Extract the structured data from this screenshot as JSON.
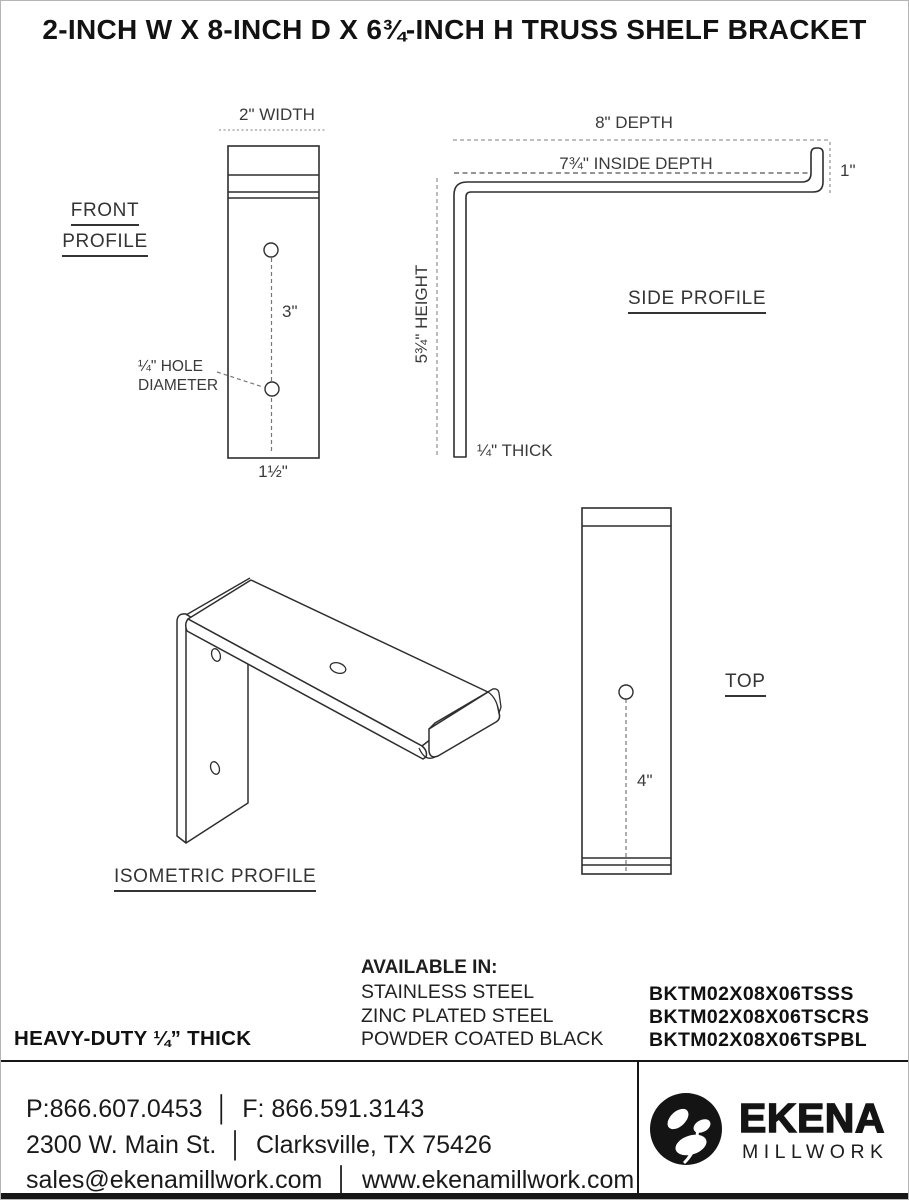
{
  "title": "2-INCH W X 8-INCH D X 6¾-INCH H TRUSS SHELF BRACKET",
  "views": {
    "front": {
      "label_line1": "FRONT",
      "label_line2": "PROFILE",
      "width_dim": "2\" WIDTH",
      "hole_spacing_dim": "3\"",
      "hole_note_line1": "¼\" HOLE",
      "hole_note_line2": "DIAMETER",
      "bottom_offset_dim": "1½\""
    },
    "side": {
      "label": "SIDE PROFILE",
      "depth_dim": "8\" DEPTH",
      "inside_depth_dim": "7¾\" INSIDE DEPTH",
      "lip_height_dim": "1\"",
      "height_dim": "5¾\" HEIGHT",
      "thickness_dim": "¼\" THICK"
    },
    "isometric": {
      "label": "ISOMETRIC PROFILE"
    },
    "top": {
      "label": "TOP",
      "hole_offset_dim": "4\""
    }
  },
  "availability": {
    "heading": "AVAILABLE IN:",
    "finishes": [
      "STAINLESS STEEL",
      "ZINC PLATED STEEL",
      "POWDER COATED BLACK"
    ],
    "skus": [
      "BKTM02X08X06TSSS",
      "BKTM02X08X06TSCRS",
      "BKTM02X08X06TSPBL"
    ]
  },
  "thickness_note": "HEAVY-DUTY ¼” THICK",
  "footer": {
    "phone": "P:866.607.0453",
    "fax": "F: 866.591.3143",
    "address": "2300 W. Main St.",
    "city": "Clarksville, TX 75426",
    "email": "sales@ekenamillwork.com",
    "website": "www.ekenamillwork.com",
    "separator": "│",
    "brand": {
      "name": "EKENA",
      "sub": "MILLWORK"
    }
  },
  "colors": {
    "line": "#2e2e2e",
    "dim_line": "#999999",
    "text": "#3a3a3a",
    "ink": "#111111"
  }
}
